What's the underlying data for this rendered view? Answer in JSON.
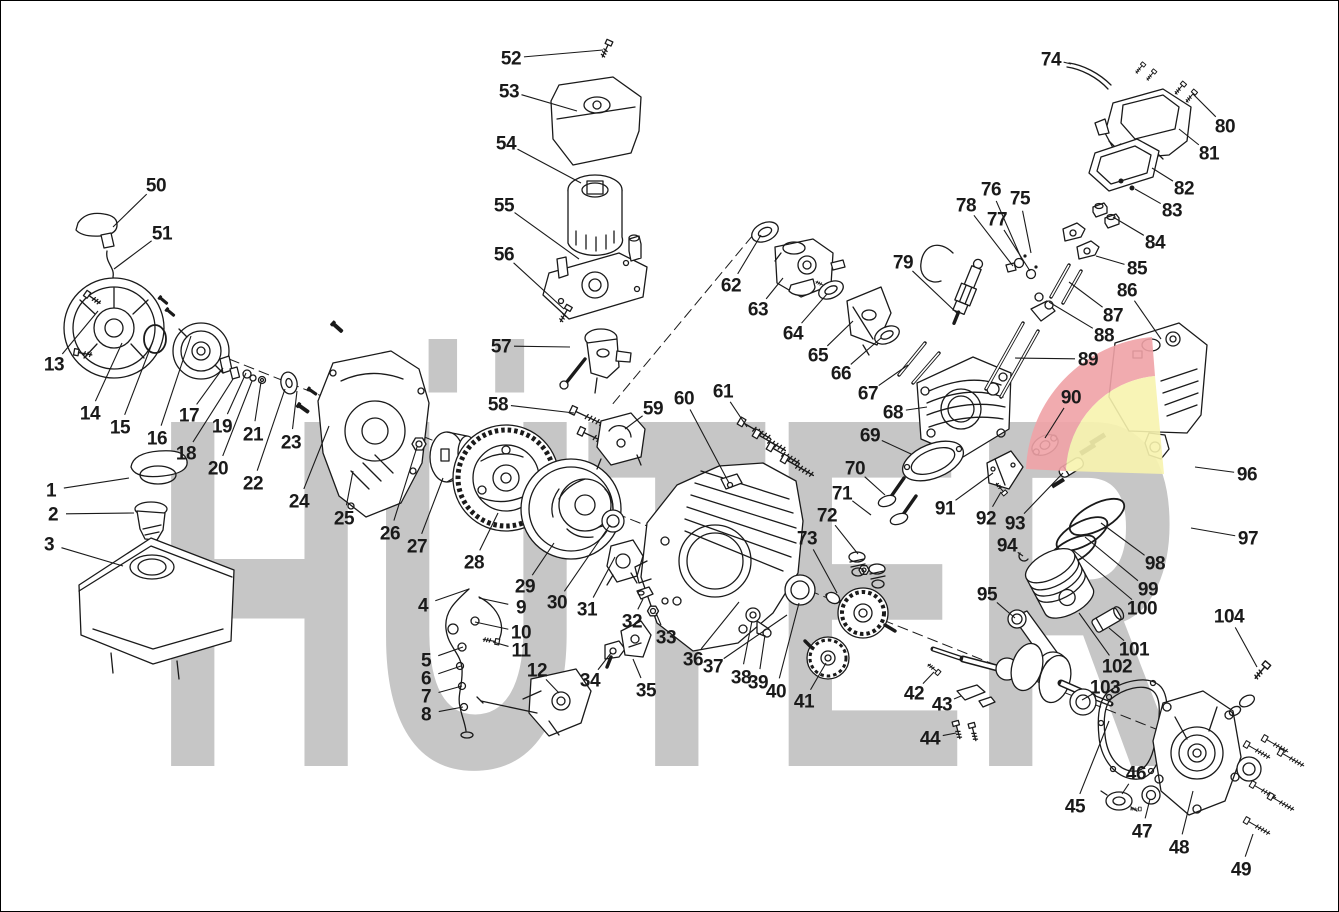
{
  "watermark": {
    "text": "HÜTER"
  },
  "colors": {
    "background": "#ffffff",
    "border": "#000000",
    "line": "#1a1a1a",
    "watermark_gray": "#c6c6c6",
    "logo_red": "#f0a2a6",
    "logo_yellow": "#f7f3ae"
  },
  "diagram_type": "engine-exploded-parts-diagram",
  "labels": [
    {
      "n": "1",
      "x": 50,
      "y": 489,
      "tx": 128,
      "ty": 477
    },
    {
      "n": "2",
      "x": 52,
      "y": 513,
      "tx": 133,
      "ty": 512
    },
    {
      "n": "3",
      "x": 48,
      "y": 543,
      "tx": 122,
      "ty": 565
    },
    {
      "n": "4",
      "x": 422,
      "y": 604,
      "tx": 468,
      "ty": 588
    },
    {
      "n": "5",
      "x": 425,
      "y": 659,
      "tx": 462,
      "ty": 646
    },
    {
      "n": "6",
      "x": 425,
      "y": 677,
      "tx": 460,
      "ty": 665
    },
    {
      "n": "7",
      "x": 425,
      "y": 695,
      "tx": 461,
      "ty": 685
    },
    {
      "n": "8",
      "x": 425,
      "y": 713,
      "tx": 462,
      "ty": 706
    },
    {
      "n": "9",
      "x": 520,
      "y": 606,
      "tx": 478,
      "ty": 597
    },
    {
      "n": "10",
      "x": 520,
      "y": 631,
      "tx": 474,
      "ty": 621
    },
    {
      "n": "11",
      "x": 520,
      "y": 649,
      "tx": 492,
      "ty": 641
    },
    {
      "n": "12",
      "x": 536,
      "y": 669,
      "tx": 558,
      "ty": 692
    },
    {
      "n": "13",
      "x": 53,
      "y": 363,
      "tx": 97,
      "ty": 310
    },
    {
      "n": "14",
      "x": 89,
      "y": 412,
      "tx": 121,
      "ty": 342
    },
    {
      "n": "15",
      "x": 119,
      "y": 426,
      "tx": 152,
      "ty": 340
    },
    {
      "n": "16",
      "x": 156,
      "y": 437,
      "tx": 190,
      "ty": 335
    },
    {
      "n": "17",
      "x": 188,
      "y": 414,
      "tx": 222,
      "ty": 367
    },
    {
      "n": "18",
      "x": 185,
      "y": 452,
      "tx": 232,
      "ty": 378
    },
    {
      "n": "19",
      "x": 221,
      "y": 425,
      "tx": 245,
      "ty": 372
    },
    {
      "n": "20",
      "x": 217,
      "y": 467,
      "tx": 251,
      "ty": 380
    },
    {
      "n": "21",
      "x": 252,
      "y": 433,
      "tx": 260,
      "ty": 381
    },
    {
      "n": "22",
      "x": 252,
      "y": 482,
      "tx": 284,
      "ty": 388
    },
    {
      "n": "23",
      "x": 290,
      "y": 441,
      "tx": 296,
      "ty": 390
    },
    {
      "n": "24",
      "x": 298,
      "y": 500,
      "tx": 328,
      "ty": 425
    },
    {
      "n": "25",
      "x": 343,
      "y": 517,
      "tx": 352,
      "ty": 470
    },
    {
      "n": "26",
      "x": 389,
      "y": 532,
      "tx": 416,
      "ty": 446
    },
    {
      "n": "27",
      "x": 416,
      "y": 545,
      "tx": 442,
      "ty": 477
    },
    {
      "n": "28",
      "x": 473,
      "y": 561,
      "tx": 497,
      "ty": 512
    },
    {
      "n": "29",
      "x": 524,
      "y": 585,
      "tx": 553,
      "ty": 542
    },
    {
      "n": "30",
      "x": 556,
      "y": 601,
      "tx": 609,
      "ty": 524
    },
    {
      "n": "31",
      "x": 586,
      "y": 608,
      "tx": 614,
      "ty": 556
    },
    {
      "n": "32",
      "x": 631,
      "y": 620,
      "tx": 642,
      "ty": 598
    },
    {
      "n": "33",
      "x": 665,
      "y": 636,
      "tx": 655,
      "ty": 612
    },
    {
      "n": "34",
      "x": 589,
      "y": 679,
      "tx": 610,
      "ty": 652
    },
    {
      "n": "35",
      "x": 645,
      "y": 689,
      "tx": 632,
      "ty": 658
    },
    {
      "n": "36",
      "x": 692,
      "y": 658,
      "tx": 738,
      "ty": 601
    },
    {
      "n": "37",
      "x": 712,
      "y": 665,
      "tx": 786,
      "ty": 614
    },
    {
      "n": "38",
      "x": 740,
      "y": 676,
      "tx": 751,
      "ty": 620
    },
    {
      "n": "39",
      "x": 757,
      "y": 681,
      "tx": 764,
      "ty": 634
    },
    {
      "n": "40",
      "x": 775,
      "y": 690,
      "tx": 798,
      "ty": 602
    },
    {
      "n": "41",
      "x": 803,
      "y": 700,
      "tx": 825,
      "ty": 662
    },
    {
      "n": "42",
      "x": 913,
      "y": 692,
      "tx": 933,
      "ty": 671
    },
    {
      "n": "43",
      "x": 941,
      "y": 703,
      "tx": 960,
      "ty": 695
    },
    {
      "n": "44",
      "x": 929,
      "y": 737,
      "tx": 955,
      "ty": 732
    },
    {
      "n": "45",
      "x": 1074,
      "y": 805,
      "tx": 1108,
      "ty": 720
    },
    {
      "n": "46",
      "x": 1135,
      "y": 772,
      "tx": 1121,
      "ty": 793
    },
    {
      "n": "47",
      "x": 1141,
      "y": 830,
      "tx": 1149,
      "ty": 798
    },
    {
      "n": "48",
      "x": 1178,
      "y": 846,
      "tx": 1192,
      "ty": 790
    },
    {
      "n": "49",
      "x": 1240,
      "y": 868,
      "tx": 1252,
      "ty": 833
    },
    {
      "n": "50",
      "x": 155,
      "y": 184,
      "tx": 112,
      "ty": 226
    },
    {
      "n": "51",
      "x": 161,
      "y": 232,
      "tx": 113,
      "ty": 268
    },
    {
      "n": "52",
      "x": 510,
      "y": 57,
      "tx": 602,
      "ty": 49
    },
    {
      "n": "53",
      "x": 508,
      "y": 90,
      "tx": 576,
      "ty": 110
    },
    {
      "n": "54",
      "x": 505,
      "y": 142,
      "tx": 580,
      "ty": 182
    },
    {
      "n": "55",
      "x": 503,
      "y": 204,
      "tx": 578,
      "ty": 258
    },
    {
      "n": "56",
      "x": 503,
      "y": 253,
      "tx": 563,
      "ty": 308
    },
    {
      "n": "57",
      "x": 500,
      "y": 345,
      "tx": 569,
      "ty": 346
    },
    {
      "n": "58",
      "x": 497,
      "y": 403,
      "tx": 573,
      "ty": 412
    },
    {
      "n": "59",
      "x": 652,
      "y": 407,
      "tx": 624,
      "ty": 428
    },
    {
      "n": "60",
      "x": 683,
      "y": 397,
      "tx": 728,
      "ty": 482
    },
    {
      "n": "61",
      "x": 722,
      "y": 390,
      "tx": 746,
      "ty": 426
    },
    {
      "n": "62",
      "x": 730,
      "y": 284,
      "tx": 760,
      "ty": 234
    },
    {
      "n": "63",
      "x": 757,
      "y": 308,
      "tx": 782,
      "ty": 277
    },
    {
      "n": "64",
      "x": 792,
      "y": 332,
      "tx": 826,
      "ty": 293
    },
    {
      "n": "65",
      "x": 817,
      "y": 354,
      "tx": 852,
      "ty": 320
    },
    {
      "n": "66",
      "x": 840,
      "y": 372,
      "tx": 880,
      "ty": 337
    },
    {
      "n": "67",
      "x": 867,
      "y": 392,
      "tx": 907,
      "ty": 364
    },
    {
      "n": "68",
      "x": 892,
      "y": 411,
      "tx": 926,
      "ty": 406
    },
    {
      "n": "69",
      "x": 869,
      "y": 434,
      "tx": 910,
      "ty": 453
    },
    {
      "n": "70",
      "x": 854,
      "y": 467,
      "tx": 884,
      "ty": 494
    },
    {
      "n": "71",
      "x": 841,
      "y": 492,
      "tx": 870,
      "ty": 514
    },
    {
      "n": "72",
      "x": 826,
      "y": 514,
      "tx": 857,
      "ty": 553
    },
    {
      "n": "73",
      "x": 806,
      "y": 537,
      "tx": 836,
      "ty": 592
    },
    {
      "n": "74",
      "x": 1050,
      "y": 58,
      "tx": 1070,
      "ty": 63
    },
    {
      "n": "75",
      "x": 1019,
      "y": 197,
      "tx": 1030,
      "ty": 252
    },
    {
      "n": "76",
      "x": 990,
      "y": 188,
      "tx": 1021,
      "ty": 259
    },
    {
      "n": "77",
      "x": 996,
      "y": 218,
      "tx": 1029,
      "ty": 270
    },
    {
      "n": "78",
      "x": 965,
      "y": 204,
      "tx": 1012,
      "ty": 265
    },
    {
      "n": "79",
      "x": 902,
      "y": 261,
      "tx": 958,
      "ty": 314
    },
    {
      "n": "80",
      "x": 1224,
      "y": 125,
      "tx": 1192,
      "ty": 93
    },
    {
      "n": "81",
      "x": 1208,
      "y": 152,
      "tx": 1178,
      "ty": 128
    },
    {
      "n": "82",
      "x": 1183,
      "y": 187,
      "tx": 1151,
      "ty": 167
    },
    {
      "n": "83",
      "x": 1171,
      "y": 209,
      "tx": 1134,
      "ty": 188
    },
    {
      "n": "84",
      "x": 1154,
      "y": 241,
      "tx": 1112,
      "ty": 216
    },
    {
      "n": "85",
      "x": 1136,
      "y": 267,
      "tx": 1095,
      "ty": 255
    },
    {
      "n": "86",
      "x": 1126,
      "y": 289,
      "tx": 1160,
      "ty": 338
    },
    {
      "n": "87",
      "x": 1112,
      "y": 314,
      "tx": 1068,
      "ty": 281
    },
    {
      "n": "88",
      "x": 1103,
      "y": 334,
      "tx": 1048,
      "ty": 301
    },
    {
      "n": "89",
      "x": 1087,
      "y": 358,
      "tx": 1014,
      "ty": 357
    },
    {
      "n": "90",
      "x": 1070,
      "y": 396,
      "tx": 1044,
      "ty": 437
    },
    {
      "n": "91",
      "x": 944,
      "y": 507,
      "tx": 992,
      "ty": 472
    },
    {
      "n": "92",
      "x": 985,
      "y": 517,
      "tx": 1000,
      "ty": 491
    },
    {
      "n": "93",
      "x": 1014,
      "y": 522,
      "tx": 1062,
      "ty": 472
    },
    {
      "n": "94",
      "x": 1006,
      "y": 544,
      "tx": 1022,
      "ty": 555
    },
    {
      "n": "95",
      "x": 986,
      "y": 593,
      "tx": 1014,
      "ty": 617
    },
    {
      "n": "96",
      "x": 1246,
      "y": 473,
      "tx": 1194,
      "ty": 466
    },
    {
      "n": "97",
      "x": 1247,
      "y": 537,
      "tx": 1190,
      "ty": 527
    },
    {
      "n": "98",
      "x": 1154,
      "y": 562,
      "tx": 1100,
      "ty": 522
    },
    {
      "n": "99",
      "x": 1147,
      "y": 588,
      "tx": 1084,
      "ty": 536
    },
    {
      "n": "100",
      "x": 1141,
      "y": 607,
      "tx": 1072,
      "ty": 549
    },
    {
      "n": "101",
      "x": 1133,
      "y": 648,
      "tx": 1108,
      "ty": 627
    },
    {
      "n": "102",
      "x": 1116,
      "y": 665,
      "tx": 1078,
      "ty": 612
    },
    {
      "n": "103",
      "x": 1104,
      "y": 686,
      "tx": 1081,
      "ty": 699
    },
    {
      "n": "104",
      "x": 1228,
      "y": 615,
      "tx": 1256,
      "ty": 666
    }
  ]
}
